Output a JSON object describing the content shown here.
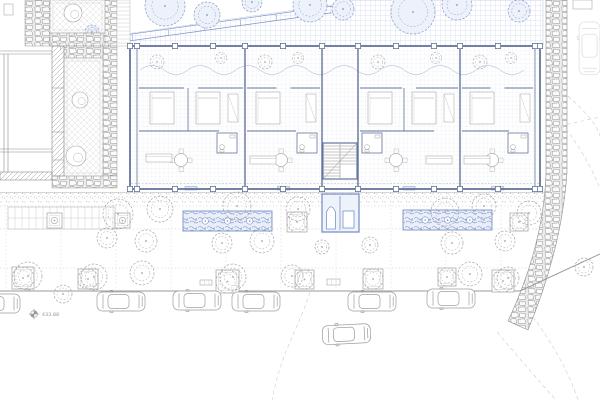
{
  "title": "Ground floor site plan",
  "labels": {
    "benchmark_elevation": "433.88"
  },
  "colors": {
    "paper": "#ffffff",
    "blue_grid": "#bac8e5",
    "blue_line": "#7b93c9",
    "blue_wall": "#64749c",
    "blue_fill": "#e9eef9",
    "gray_line": "#9a9a9a",
    "gray_light": "#c9c9c9",
    "stone": "#949494",
    "text": "#8f8f8f"
  },
  "garden": {
    "clip": "126,46 126,34 352,2 352,0 543,0 543,46",
    "diagonal": [
      [
        60,
        44,
        348,
        4
      ],
      [
        64,
        50,
        352,
        10
      ]
    ],
    "trees": [
      [
        165,
        6,
        20
      ],
      [
        207,
        15,
        13
      ],
      [
        252,
        2,
        10
      ],
      [
        310,
        5,
        17
      ],
      [
        343,
        9,
        11
      ],
      [
        413,
        12,
        22
      ],
      [
        457,
        5,
        15
      ],
      [
        519,
        11,
        11
      ],
      [
        92,
        32,
        7
      ]
    ]
  },
  "neighbor": {
    "stones": [
      [
        25,
        0,
        25,
        46
      ],
      [
        50,
        33,
        67,
        13
      ],
      [
        105,
        0,
        12,
        46
      ],
      [
        103,
        46,
        14,
        130
      ],
      [
        64,
        46,
        39,
        12
      ],
      [
        52,
        176,
        65,
        12
      ]
    ],
    "courtyards": [
      {
        "rect": [
          50,
          0,
          55,
          33
        ],
        "trees": [
          [
            73,
            13,
            9
          ]
        ]
      },
      {
        "rect": [
          64,
          58,
          39,
          118
        ],
        "trees": [
          [
            80,
            100,
            8
          ],
          [
            76,
            156,
            10
          ]
        ]
      }
    ],
    "hatch_wall": [
      52,
      46,
      12,
      130
    ],
    "hatch_stub": [
      0,
      172,
      52,
      8
    ],
    "lines": [
      [
        0,
        51,
        52,
        51
      ],
      [
        0,
        54,
        52,
        54
      ],
      [
        0,
        149,
        52,
        149
      ],
      [
        0,
        152,
        52,
        152
      ],
      [
        4,
        54,
        4,
        172
      ],
      [
        8,
        54,
        8,
        172
      ]
    ],
    "ladder": [
      117,
      0,
      13,
      46
    ]
  },
  "building": {
    "x": 130,
    "y": 46,
    "w": 410,
    "h": 143,
    "dividers": [
      137,
      245,
      322,
      358,
      460,
      535
    ],
    "pilasters": [
      130,
      137,
      175,
      213,
      245,
      283,
      322,
      358,
      396,
      434,
      460,
      498,
      535,
      540
    ],
    "stair": {
      "x": 323,
      "y": 143,
      "w": 34,
      "h": 36
    },
    "units": [
      {
        "x": 137,
        "w": 108,
        "beds": [
          [
            150,
            92
          ],
          [
            196,
            92
          ]
        ],
        "bdiv": 188,
        "wardrobe": [
          228,
          94
        ],
        "table": [
          181,
          160
        ],
        "bath": [
          217,
          133
        ],
        "sofa": [
          146,
          154
        ]
      },
      {
        "x": 245,
        "w": 77,
        "beds": [
          [
            256,
            92
          ]
        ],
        "wardrobe": [
          306,
          94
        ],
        "table": [
          281,
          160
        ],
        "bath": [
          297,
          133
        ],
        "sofa": [
          250,
          156
        ]
      },
      {
        "x": 358,
        "w": 102,
        "beds": [
          [
            368,
            92
          ],
          [
            412,
            92
          ]
        ],
        "bdiv": 404,
        "wardrobe": [
          444,
          94
        ],
        "table": [
          396,
          160
        ],
        "bath": [
          362,
          133
        ],
        "sofa": [
          426,
          156
        ]
      },
      {
        "x": 460,
        "w": 75,
        "beds": [
          [
            470,
            92
          ]
        ],
        "wardrobe": [
          520,
          94
        ],
        "table": [
          492,
          160
        ],
        "bath": [
          508,
          133
        ],
        "sofa": [
          464,
          156
        ]
      }
    ]
  },
  "stone_wall_right": {
    "path": "M546,0 L567,0 L567,172 Q562,248 528,330 L508,321 Q543,247 546,175 Z"
  },
  "sidewalk": {
    "rect": [
      0,
      193,
      546,
      11
    ]
  },
  "plaza": {
    "joint_xs": [
      6,
      61,
      116,
      171,
      226,
      281,
      336,
      391,
      446,
      501
    ],
    "hlines": [
      206,
      229,
      268
    ],
    "curb": [
      [
        0,
        291
      ],
      [
        520,
        291
      ],
      [
        600,
        254
      ]
    ],
    "ladders": [
      [
        8,
        207,
        107,
        22
      ]
    ],
    "benches": [
      [
        220,
        212,
        32,
        18
      ],
      [
        261,
        216,
        9,
        7
      ],
      [
        200,
        280,
        12,
        5
      ],
      [
        327,
        279,
        13,
        6
      ]
    ],
    "square_planters": [
      [
        47,
        213,
        15
      ],
      [
        115,
        213,
        15
      ],
      [
        287,
        212,
        20
      ],
      [
        510,
        213,
        18
      ],
      [
        12,
        267,
        22
      ],
      [
        78,
        269,
        20
      ],
      [
        216,
        270,
        23
      ],
      [
        295,
        270,
        19
      ],
      [
        363,
        269,
        20
      ],
      [
        438,
        268,
        18
      ],
      [
        492,
        270,
        22
      ]
    ],
    "blue_planters": [
      [
        183,
        211,
        89,
        20
      ],
      [
        403,
        210,
        89,
        20
      ]
    ],
    "pavilion": {
      "x": 322,
      "y": 194,
      "w": 37,
      "h": 38
    },
    "trees": [
      [
        118,
        214,
        15
      ],
      [
        160,
        209,
        13
      ],
      [
        107,
        238,
        10
      ],
      [
        146,
        241,
        11
      ],
      [
        237,
        206,
        14
      ],
      [
        222,
        243,
        10
      ],
      [
        262,
        241,
        12
      ],
      [
        298,
        209,
        12
      ],
      [
        445,
        212,
        14
      ],
      [
        484,
        206,
        12
      ],
      [
        452,
        243,
        11
      ],
      [
        529,
        213,
        12
      ],
      [
        505,
        241,
        10
      ],
      [
        28,
        276,
        14
      ],
      [
        94,
        277,
        13
      ],
      [
        142,
        273,
        12
      ],
      [
        233,
        277,
        13
      ],
      [
        292,
        276,
        11
      ],
      [
        470,
        274,
        12
      ],
      [
        508,
        278,
        11
      ],
      [
        584,
        267,
        9
      ],
      [
        63,
        294,
        9
      ],
      [
        370,
        245,
        8
      ],
      [
        322,
        247,
        7
      ]
    ]
  },
  "street": {
    "cars": [
      {
        "x": -28,
        "y": 294
      },
      {
        "x": 97,
        "y": 292
      },
      {
        "x": 173,
        "y": 291
      },
      {
        "x": 232,
        "y": 292
      },
      {
        "x": 348,
        "y": 292
      },
      {
        "x": 427,
        "y": 289
      }
    ],
    "moving_car": {
      "x": 322,
      "y": 326,
      "rot": -3
    },
    "faint_car": {
      "x": 600,
      "y": 22,
      "rot": 90,
      "scale": 1.1,
      "opacity": 0.38
    }
  },
  "benchmark": {
    "x": 34,
    "y": 314
  },
  "misc_rects": [
    [
      4,
      4,
      9,
      11
    ],
    [
      573,
      0,
      19,
      9
    ]
  ],
  "faint_paths": [
    "M553,112 Q583,148 599,186",
    "M568,96 Q597,122 600,136",
    "M497,332 Q530,371 556,400",
    "M520,300 Q562,352 578,400",
    "M310,292 C298,330 281,352 272,400",
    "M560,126 L600,117",
    "M550,14 Q557,60 549,106"
  ]
}
